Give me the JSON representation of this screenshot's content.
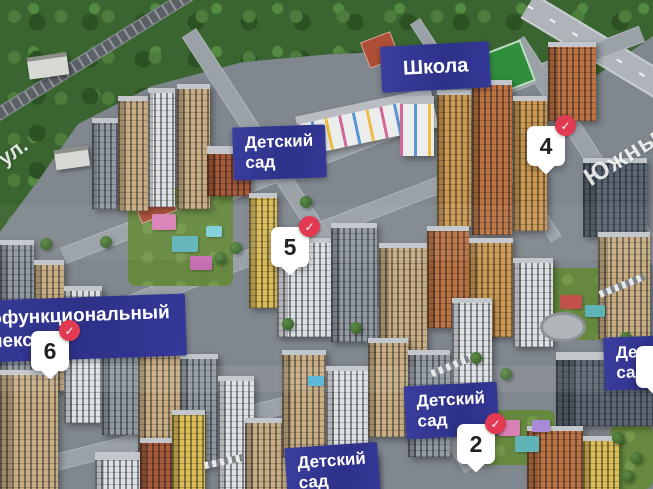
{
  "labels": {
    "school": "Школа",
    "kindergarten": {
      "line1": "Детский",
      "line2": "сад"
    },
    "multifunctional": {
      "line1": "Многофункциональный",
      "line2": "комплекс"
    }
  },
  "streets": {
    "left": "ул.",
    "right": "Южный"
  },
  "pins": {
    "pin4": {
      "number": "4",
      "checked": true
    },
    "pin5": {
      "number": "5",
      "checked": true
    },
    "pin6": {
      "number": "6",
      "checked": true
    },
    "pin2": {
      "number": "2",
      "checked": true
    }
  },
  "badge": {
    "checkmark": "✓"
  },
  "colors": {
    "label_bg": "#2e3188",
    "badge_red": "#e13a52",
    "pin_bg": "#ffffff",
    "pin_text": "#222222"
  }
}
